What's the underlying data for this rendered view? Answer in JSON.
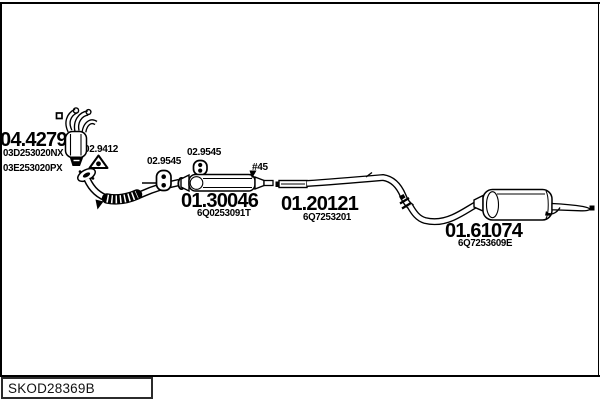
{
  "frame": {
    "background": "#ffffff",
    "line_color": "#000000"
  },
  "drawing_code": "SKOD28369B",
  "parts": {
    "catalytic": {
      "code": "04.4279",
      "oem_numbers": [
        "03D253020NX",
        "03E253020PX"
      ]
    },
    "gasket": {
      "code": "02.9412"
    },
    "hanger_front": {
      "code": "02.9545"
    },
    "hanger_mid": {
      "code": "02.9545"
    },
    "middle_silencer": {
      "code": "01.30046",
      "oem": "6Q0253091T"
    },
    "fitting_mark": {
      "code": "#45"
    },
    "centre_pipe": {
      "code": "01.20121",
      "oem": "6Q7253201"
    },
    "rear_silencer": {
      "code": "01.61074",
      "oem": "6Q7253609E"
    }
  },
  "icons": {
    "gasket": "triangle-gasket-icon",
    "hanger": "rubber-hanger-icon",
    "pointer": "pointer-arrow-icon",
    "mount": "mount-square-icon"
  }
}
